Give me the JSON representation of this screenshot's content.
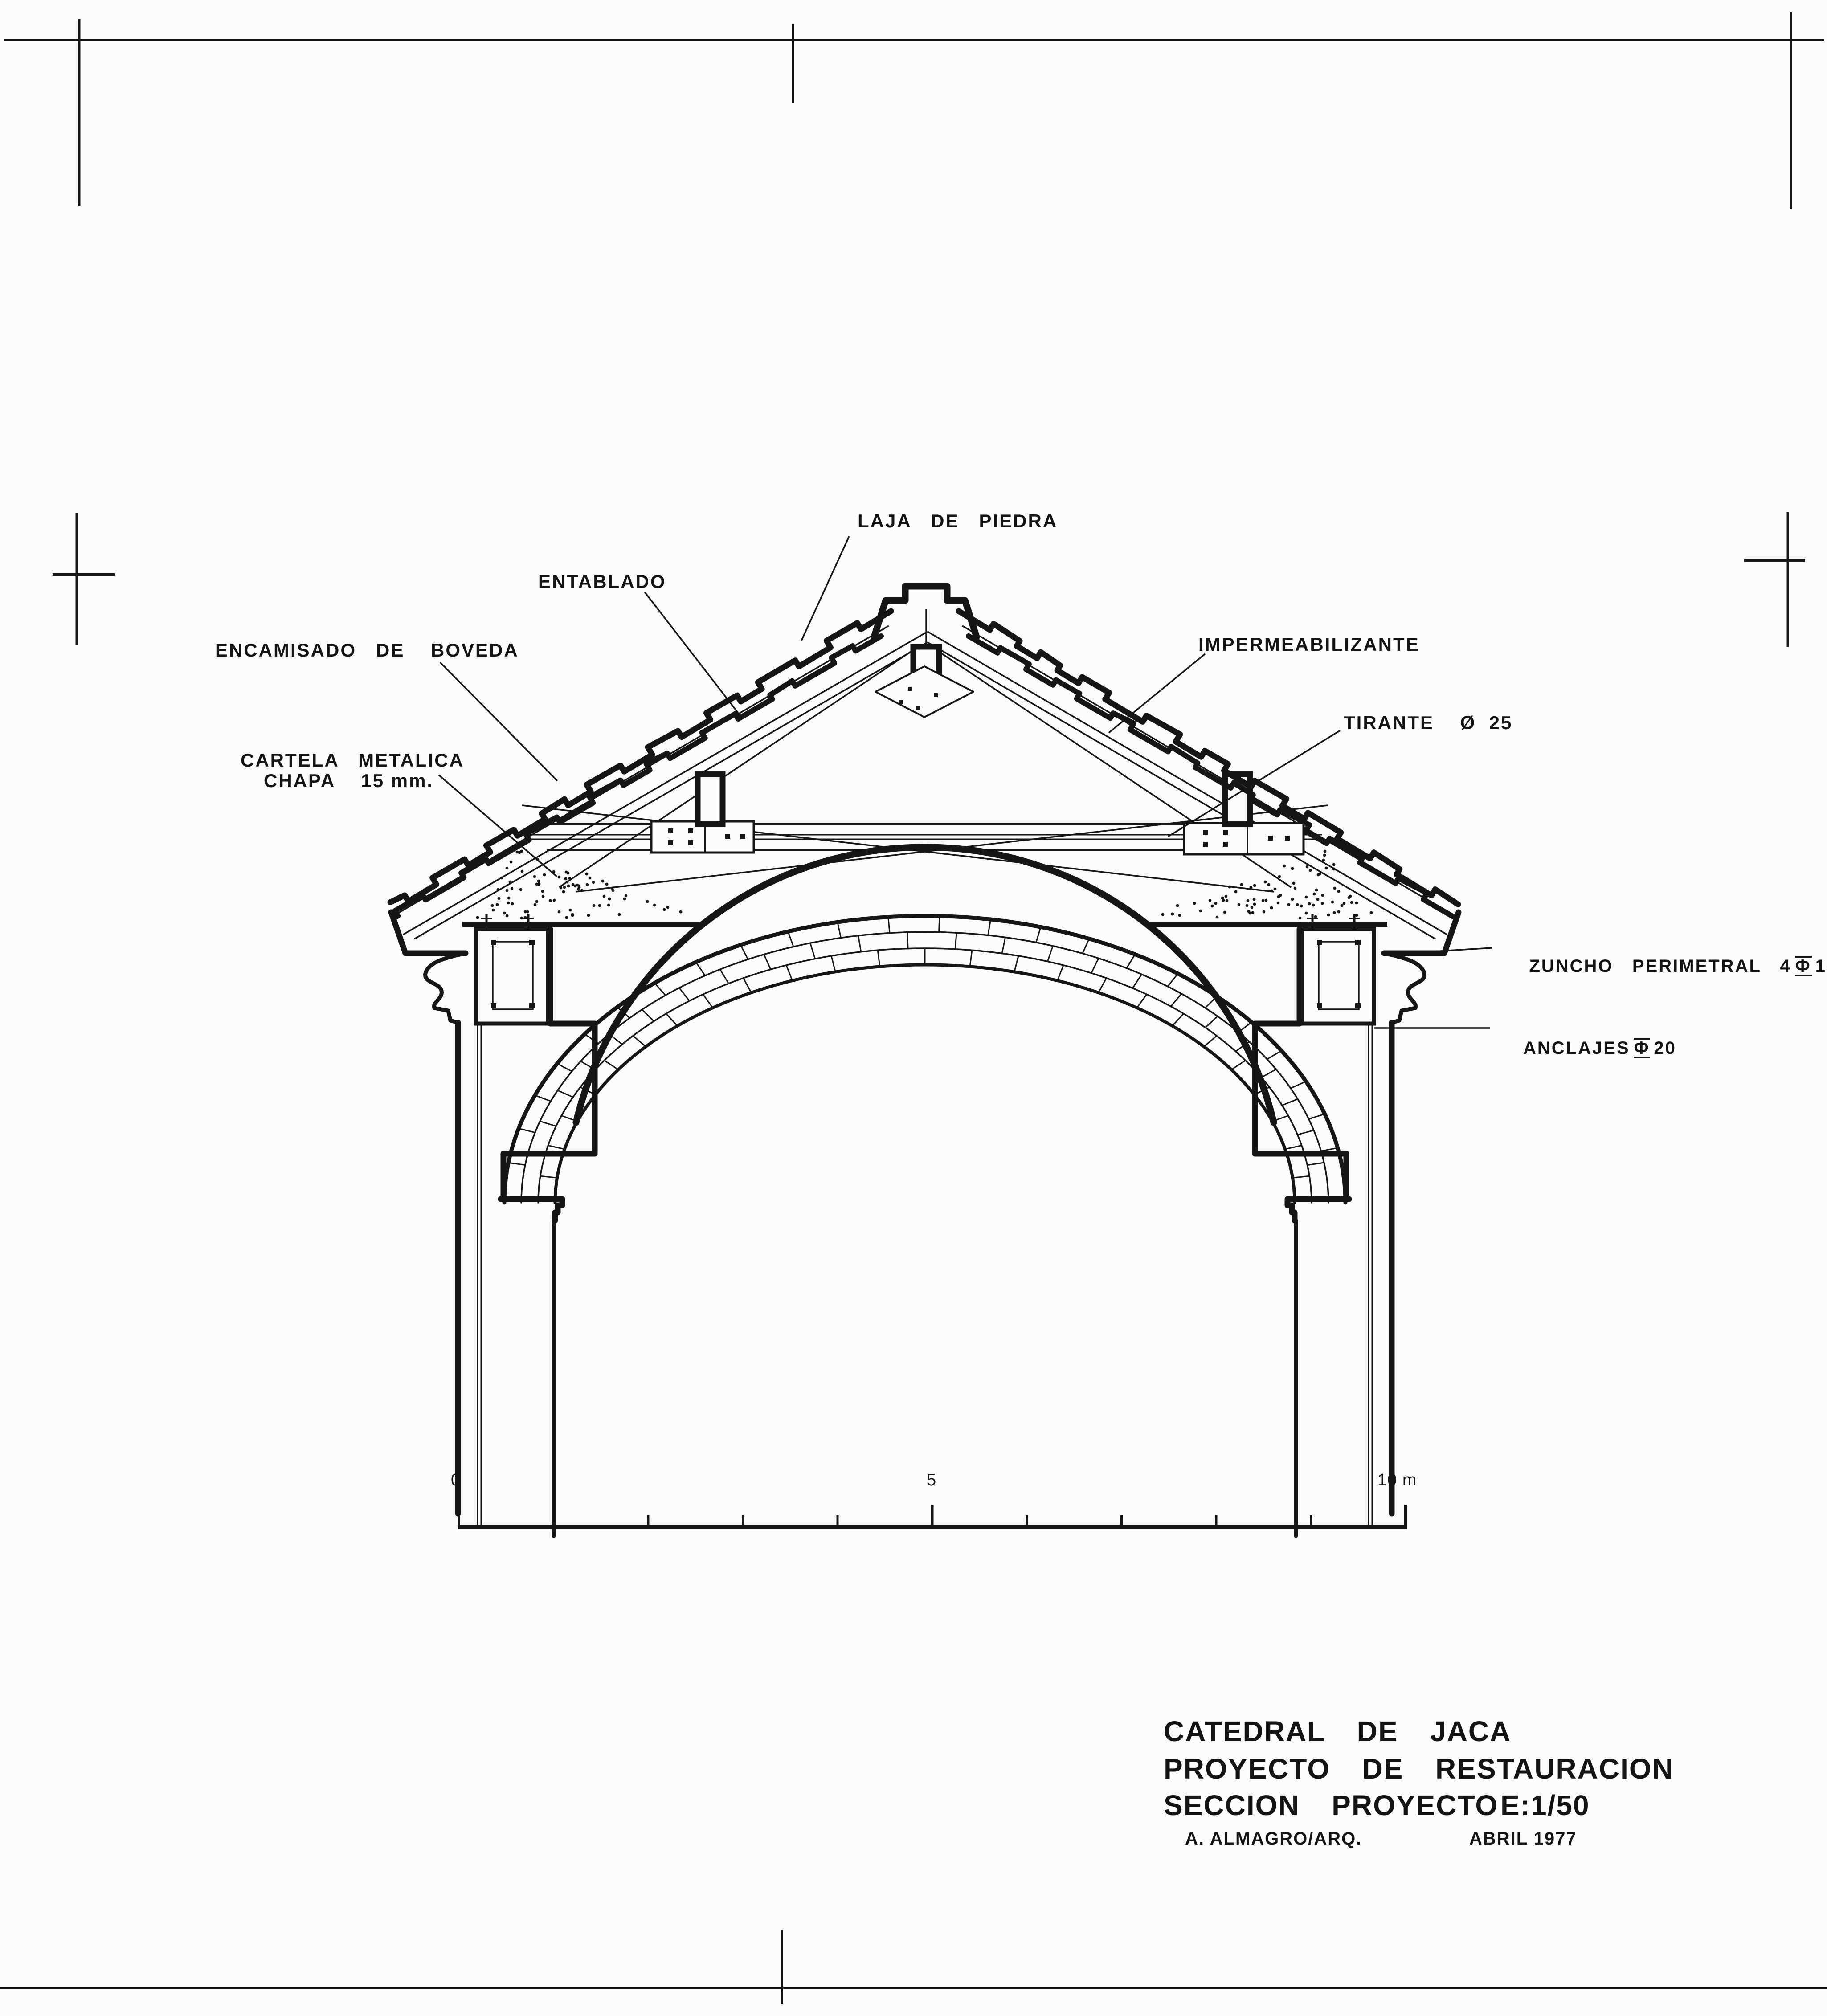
{
  "labels": {
    "laja": "LAJA   DE   PIEDRA",
    "entablado": "ENTABLADO",
    "encamisado": "ENCAMISADO   DE    BOVEDA",
    "cartela_line1": "CARTELA   METALICA",
    "cartela_line2": "CHAPA    15 mm.",
    "impermeabilizante": "IMPERMEABILIZANTE",
    "tirante": "TIRANTE    Ø  25",
    "zuncho_pre": "ZUNCHO   PERIMETRAL   4",
    "zuncho_sym": "Φ",
    "zuncho_post": "14",
    "anclajes_pre": "ANCLAJES",
    "anclajes_sym": "Φ",
    "anclajes_post": "20"
  },
  "scale_bar": {
    "start": "0",
    "mid": "5",
    "end": "10 m"
  },
  "title_block": {
    "line1": "CATEDRAL  DE  JACA",
    "line2": "PROYECTO  DE  RESTAURACION",
    "line3": "SECCION  PROYECTO",
    "scale": "E:1/50",
    "author": "A. ALMAGRO/ARQ.",
    "date": "ABRIL 1977"
  }
}
